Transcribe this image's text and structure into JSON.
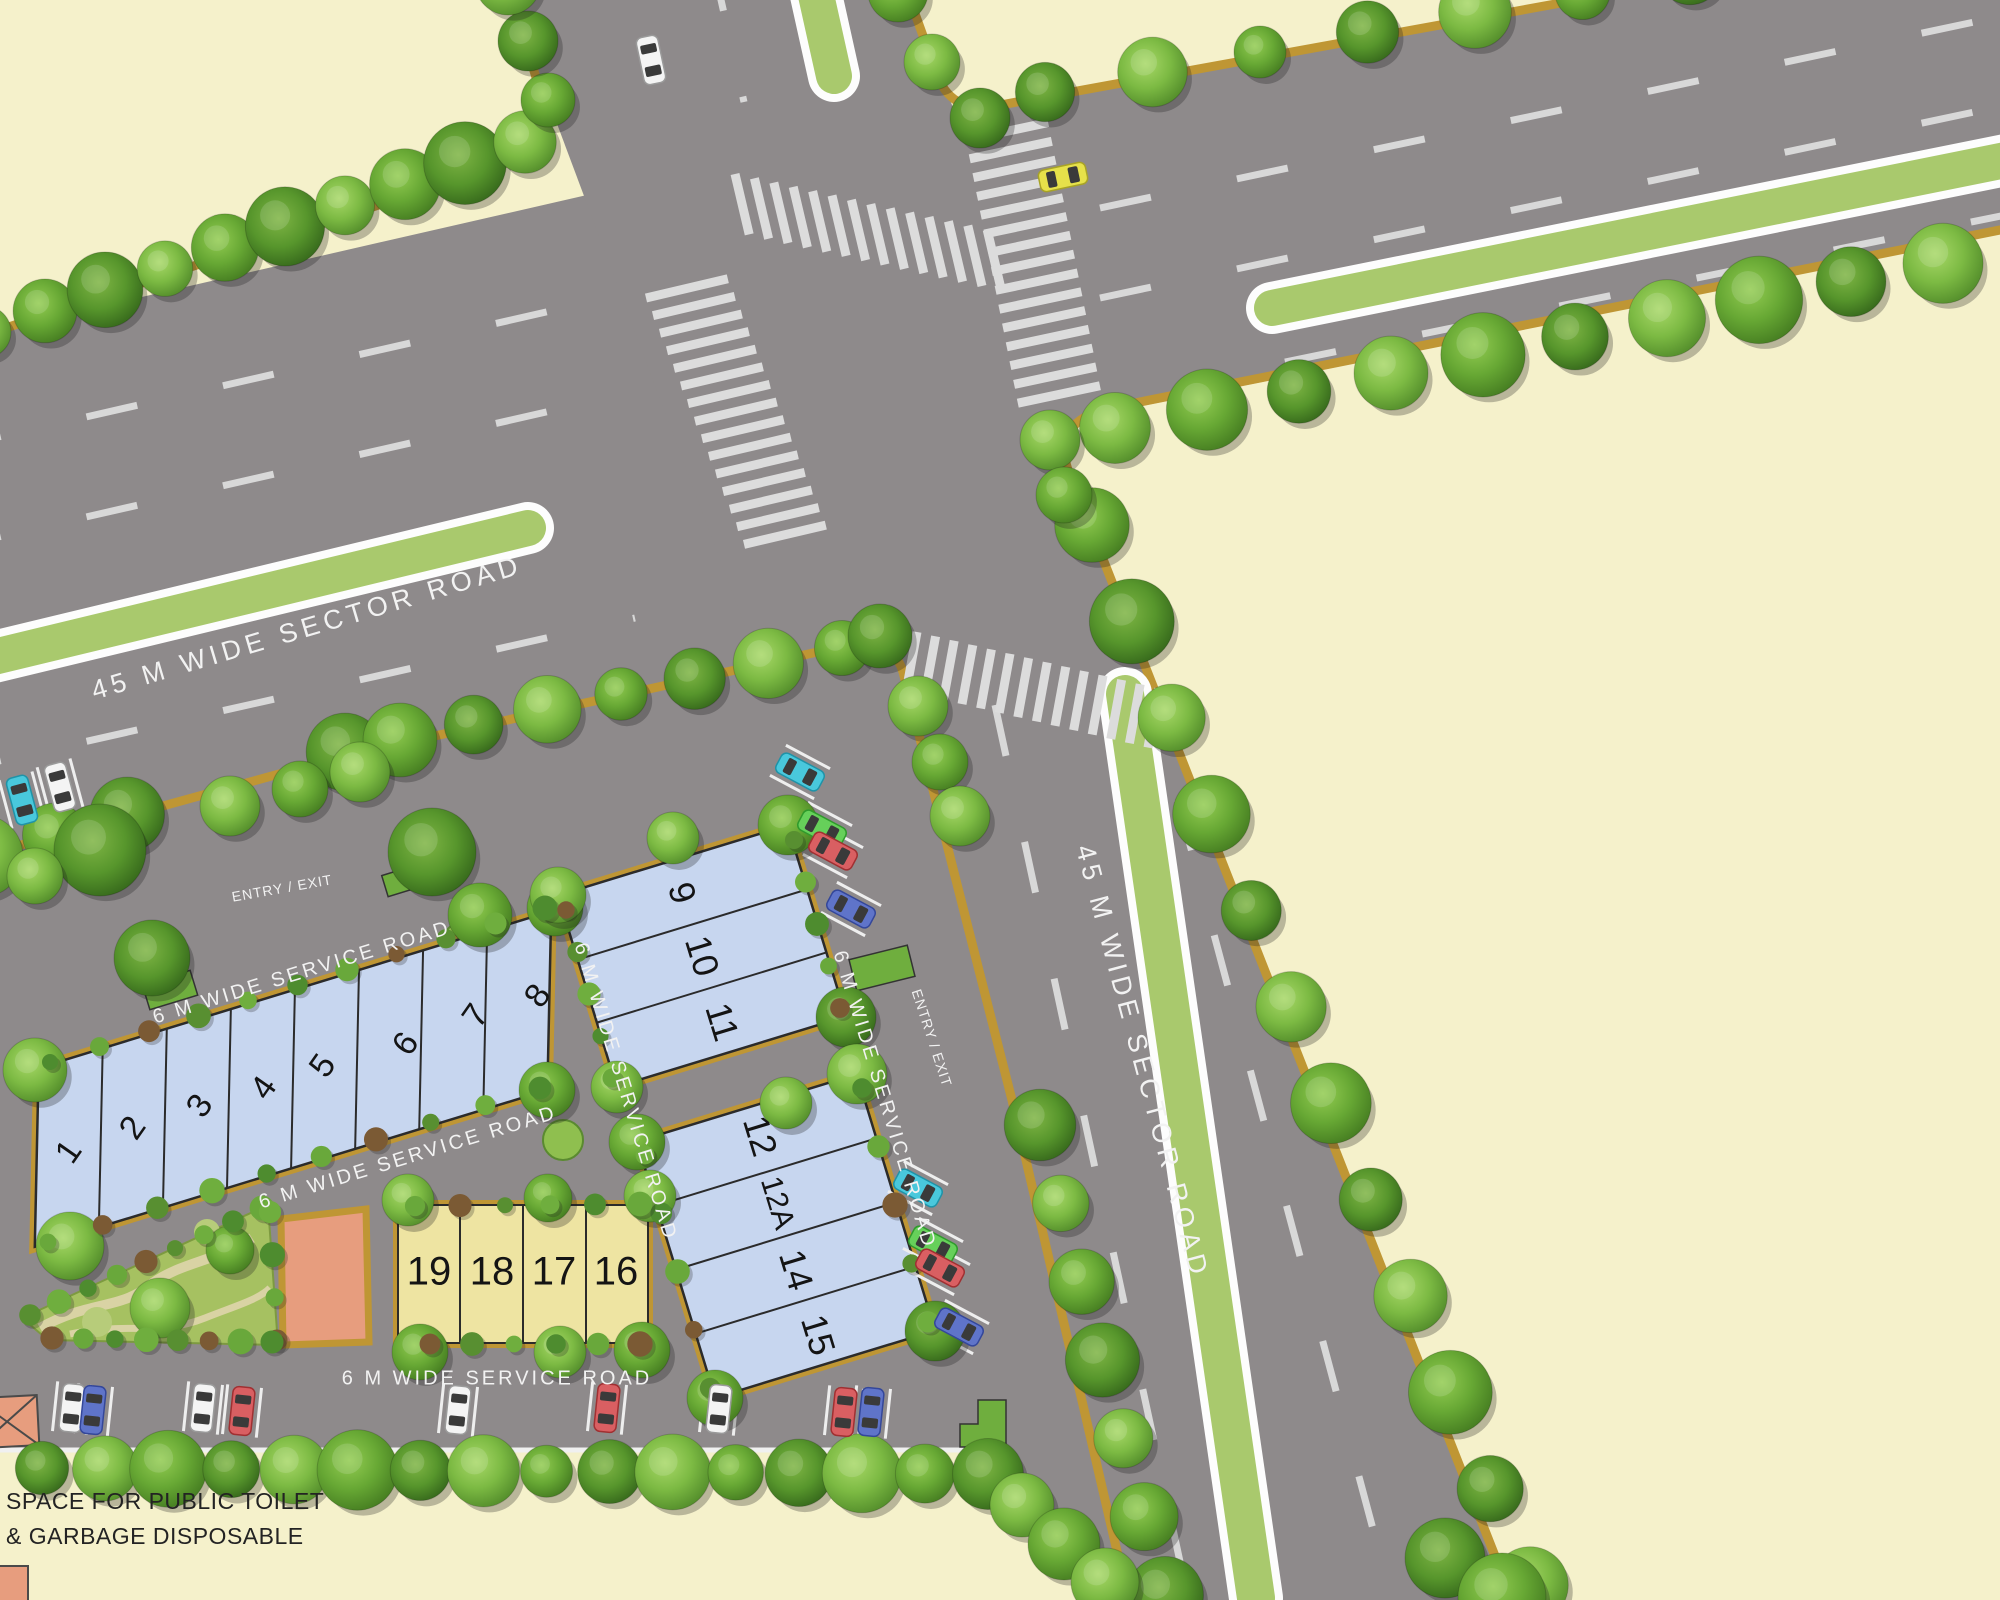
{
  "title": "Plotted development site plan",
  "roads": {
    "sector_west": "45 M WIDE SECTOR ROAD",
    "sector_south": "45 M WIDE SECTOR ROAD",
    "service": [
      "6 M WIDE SERVICE ROAD",
      "6 M WIDE SERVICE ROAD",
      "6 M WIDE SERVICE ROAD",
      "6 M WIDE SERVICE ROAD",
      "6 M WIDE SERVICE ROAD"
    ],
    "entry_exit": [
      "ENTRY / EXIT",
      "ENTRY / EXIT"
    ]
  },
  "plots": {
    "row": [
      "1",
      "2",
      "3",
      "4",
      "5",
      "6",
      "7",
      "8"
    ],
    "block_a": [
      "9",
      "10",
      "11"
    ],
    "block_b": [
      "12",
      "12A",
      "14",
      "15"
    ],
    "yellow": [
      "19",
      "18",
      "17",
      "16"
    ]
  },
  "note": {
    "line1": "SPACE FOR PUBLIC TOILET",
    "line2": "& GARBAGE DISPOSABLE"
  },
  "colors": {
    "background": "#f5f1cb",
    "road": "#8e8a8b",
    "curb": "#bf9634",
    "median_green": "#a9c96d",
    "plot_blue": "#c7d6ef",
    "plot_yellow": "#eee4a2",
    "plot_orange": "#e79d7e",
    "park_green": "#a6c161",
    "marking_white": "#d9d9d9"
  }
}
